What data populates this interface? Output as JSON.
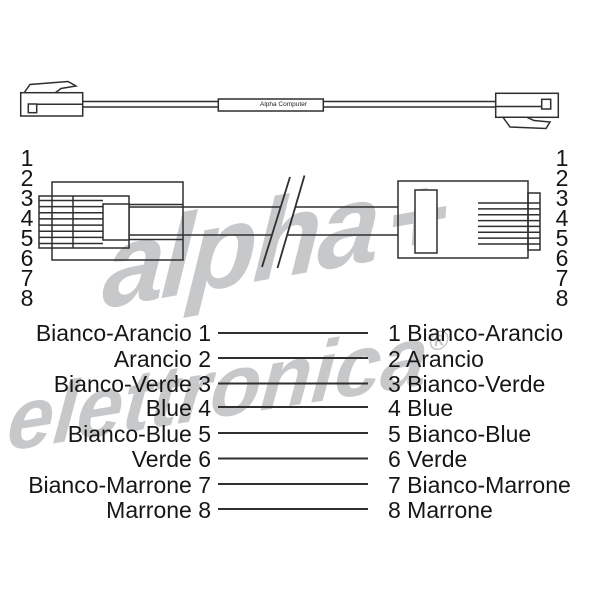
{
  "watermark": {
    "line1": "alpha",
    "plus": "+",
    "line2": "elettronica",
    "registered": "®",
    "color": "#c6c8ca"
  },
  "top_view": {
    "cable_label": "Alpha Computer"
  },
  "pins": {
    "left": [
      "1",
      "2",
      "3",
      "4",
      "5",
      "6",
      "7",
      "8"
    ],
    "right": [
      "1",
      "2",
      "3",
      "4",
      "5",
      "6",
      "7",
      "8"
    ]
  },
  "wiring": {
    "rows": [
      {
        "left": "Bianco-Arancio 1",
        "right": "1 Bianco-Arancio"
      },
      {
        "left": "Arancio 2",
        "right": "2 Arancio"
      },
      {
        "left": "Bianco-Verde 3",
        "right": "3 Bianco-Verde"
      },
      {
        "left": "Blue 4",
        "right": "4 Blue"
      },
      {
        "left": "Bianco-Blue 5",
        "right": "5 Bianco-Blue"
      },
      {
        "left": "Verde 6",
        "right": "6 Verde"
      },
      {
        "left": "Bianco-Marrone 7",
        "right": "7 Bianco-Marrone"
      },
      {
        "left": "Marrone 8",
        "right": "8 Marrone"
      }
    ]
  },
  "colors": {
    "line": "#2f2f2f",
    "text": "#161616"
  }
}
